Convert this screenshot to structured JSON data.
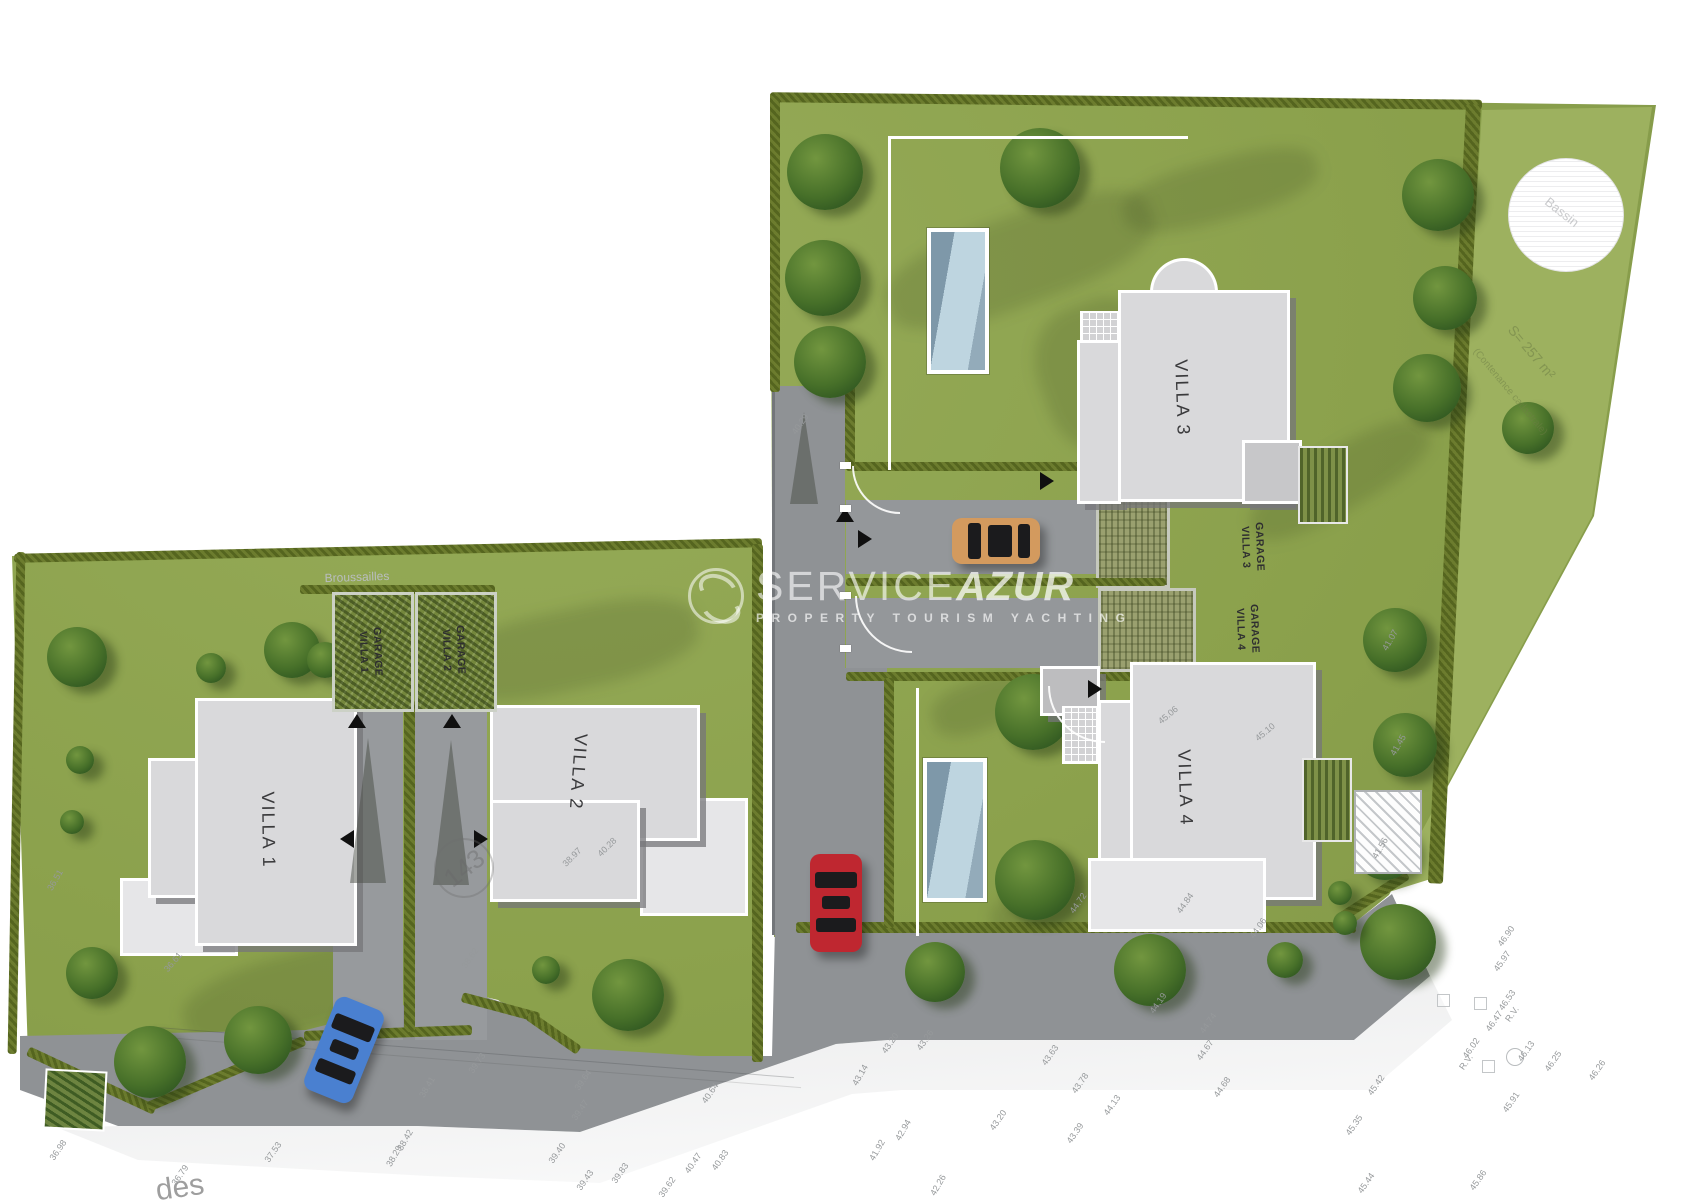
{
  "watermark": {
    "brand_light": "SERVICE",
    "brand_bold": "AZUR",
    "tagline": "PROPERTY TOURISM YACHTING"
  },
  "villas": [
    {
      "id": "villa-1",
      "label": "VILLA 1"
    },
    {
      "id": "villa-2",
      "label": "VILLA 2"
    },
    {
      "id": "villa-3",
      "label": "VILLA 3"
    },
    {
      "id": "villa-4",
      "label": "VILLA 4"
    }
  ],
  "garages": [
    {
      "id": "garage-villa-1",
      "line1": "GARAGE",
      "line2": "VILLA 1"
    },
    {
      "id": "garage-villa-2",
      "line1": "GARAGE",
      "line2": "VILLA 2"
    },
    {
      "id": "garage-villa-3",
      "line1": "GARAGE",
      "line2": "VILLA 3"
    },
    {
      "id": "garage-villa-4",
      "line1": "GARAGE",
      "line2": "VILLA 4"
    }
  ],
  "parcel_circle": "143",
  "street_label": "des",
  "notes": {
    "broussailles": "Broussailles",
    "surface": "S= 257 m²",
    "surface_sub": "(Contenance cadastrale)",
    "basin": "Bassin"
  },
  "colors": {
    "grass": "#8da24e",
    "grass_light": "#9db15f",
    "hedge": "#5d6c24",
    "road": "#8f9295",
    "road_light": "#b9bcbe",
    "building": "#d9d9db",
    "terrace": "#e6e6e8",
    "pool_water": "#a9c3d2",
    "car_red": "#bf2730",
    "car_blue": "#4a80d0",
    "car_tan": "#d39a5e"
  },
  "survey_points": [
    {
      "t": "38.62",
      "x": 470,
      "y": 958,
      "r": -55
    },
    {
      "t": "39.73",
      "x": 477,
      "y": 1063,
      "r": -55
    },
    {
      "t": "38.41",
      "x": 427,
      "y": 1087,
      "r": -60
    },
    {
      "t": "39.64",
      "x": 583,
      "y": 1080,
      "r": -55
    },
    {
      "t": "39.47",
      "x": 580,
      "y": 1110,
      "r": -55
    },
    {
      "t": "39.40",
      "x": 557,
      "y": 1153,
      "r": -55
    },
    {
      "t": "40.64",
      "x": 710,
      "y": 1093,
      "r": -55
    },
    {
      "t": "40.83",
      "x": 720,
      "y": 1160,
      "r": -55
    },
    {
      "t": "40.47",
      "x": 693,
      "y": 1163,
      "r": -55
    },
    {
      "t": "39.83",
      "x": 620,
      "y": 1173,
      "r": -55
    },
    {
      "t": "39.62",
      "x": 667,
      "y": 1187,
      "r": -55
    },
    {
      "t": "39.43",
      "x": 585,
      "y": 1180,
      "r": -55
    },
    {
      "t": "38.42",
      "x": 405,
      "y": 1140,
      "r": -60
    },
    {
      "t": "38.29",
      "x": 394,
      "y": 1156,
      "r": -60
    },
    {
      "t": "36.79",
      "x": 180,
      "y": 1175,
      "r": -55
    },
    {
      "t": "37.53",
      "x": 273,
      "y": 1152,
      "r": -55
    },
    {
      "t": "36.98",
      "x": 58,
      "y": 1150,
      "r": -55
    },
    {
      "t": "36.51",
      "x": 55,
      "y": 880,
      "r": -60
    },
    {
      "t": "36.61",
      "x": 173,
      "y": 962,
      "r": -50
    },
    {
      "t": "40.29",
      "x": 800,
      "y": 424,
      "r": -55
    },
    {
      "t": "40.28",
      "x": 607,
      "y": 847,
      "r": -45
    },
    {
      "t": "38.97",
      "x": 572,
      "y": 857,
      "r": -45
    },
    {
      "t": "45.06",
      "x": 1168,
      "y": 715,
      "r": -40
    },
    {
      "t": "45.10",
      "x": 1265,
      "y": 732,
      "r": -40
    },
    {
      "t": "44.72",
      "x": 1078,
      "y": 903,
      "r": -55
    },
    {
      "t": "44.84",
      "x": 1185,
      "y": 903,
      "r": -55
    },
    {
      "t": "44.06",
      "x": 1258,
      "y": 928,
      "r": -55
    },
    {
      "t": "43.20",
      "x": 890,
      "y": 1043,
      "r": -55
    },
    {
      "t": "43.26",
      "x": 925,
      "y": 1040,
      "r": -55
    },
    {
      "t": "43.63",
      "x": 1050,
      "y": 1055,
      "r": -55
    },
    {
      "t": "43.78",
      "x": 1080,
      "y": 1083,
      "r": -55
    },
    {
      "t": "44.19",
      "x": 1158,
      "y": 1003,
      "r": -55
    },
    {
      "t": "44.74",
      "x": 1208,
      "y": 1023,
      "r": -55
    },
    {
      "t": "44.67",
      "x": 1205,
      "y": 1050,
      "r": -55
    },
    {
      "t": "44.68",
      "x": 1222,
      "y": 1087,
      "r": -55
    },
    {
      "t": "44.13",
      "x": 1112,
      "y": 1105,
      "r": -55
    },
    {
      "t": "43.39",
      "x": 1075,
      "y": 1133,
      "r": -55
    },
    {
      "t": "43.20",
      "x": 998,
      "y": 1120,
      "r": -55
    },
    {
      "t": "42.94",
      "x": 903,
      "y": 1130,
      "r": -60
    },
    {
      "t": "41.92",
      "x": 877,
      "y": 1150,
      "r": -60
    },
    {
      "t": "42.26",
      "x": 938,
      "y": 1185,
      "r": -60
    },
    {
      "t": "43.14",
      "x": 860,
      "y": 1075,
      "r": -60
    },
    {
      "t": "46.53",
      "x": 1507,
      "y": 1000,
      "r": -55
    },
    {
      "t": "R.V.",
      "x": 1512,
      "y": 1014,
      "r": -55
    },
    {
      "t": "46.47",
      "x": 1494,
      "y": 1021,
      "r": -55
    },
    {
      "t": "46.02",
      "x": 1471,
      "y": 1048,
      "r": -55
    },
    {
      "t": "R.V.",
      "x": 1466,
      "y": 1062,
      "r": -55
    },
    {
      "t": "46.13",
      "x": 1526,
      "y": 1051,
      "r": -55
    },
    {
      "t": "46.25",
      "x": 1553,
      "y": 1061,
      "r": -55
    },
    {
      "t": "46.26",
      "x": 1597,
      "y": 1070,
      "r": -55
    },
    {
      "t": "45.42",
      "x": 1376,
      "y": 1085,
      "r": -55
    },
    {
      "t": "45.91",
      "x": 1511,
      "y": 1102,
      "r": -55
    },
    {
      "t": "45.35",
      "x": 1354,
      "y": 1125,
      "r": -55
    },
    {
      "t": "45.44",
      "x": 1366,
      "y": 1183,
      "r": -55
    },
    {
      "t": "45.86",
      "x": 1478,
      "y": 1180,
      "r": -55
    },
    {
      "t": "46.90",
      "x": 1506,
      "y": 936,
      "r": -55
    },
    {
      "t": "45.97",
      "x": 1502,
      "y": 961,
      "r": -55
    },
    {
      "t": "41.07",
      "x": 1390,
      "y": 640,
      "r": -60
    },
    {
      "t": "41.45",
      "x": 1398,
      "y": 745,
      "r": -60
    },
    {
      "t": "41.56",
      "x": 1380,
      "y": 848,
      "r": -60
    }
  ]
}
